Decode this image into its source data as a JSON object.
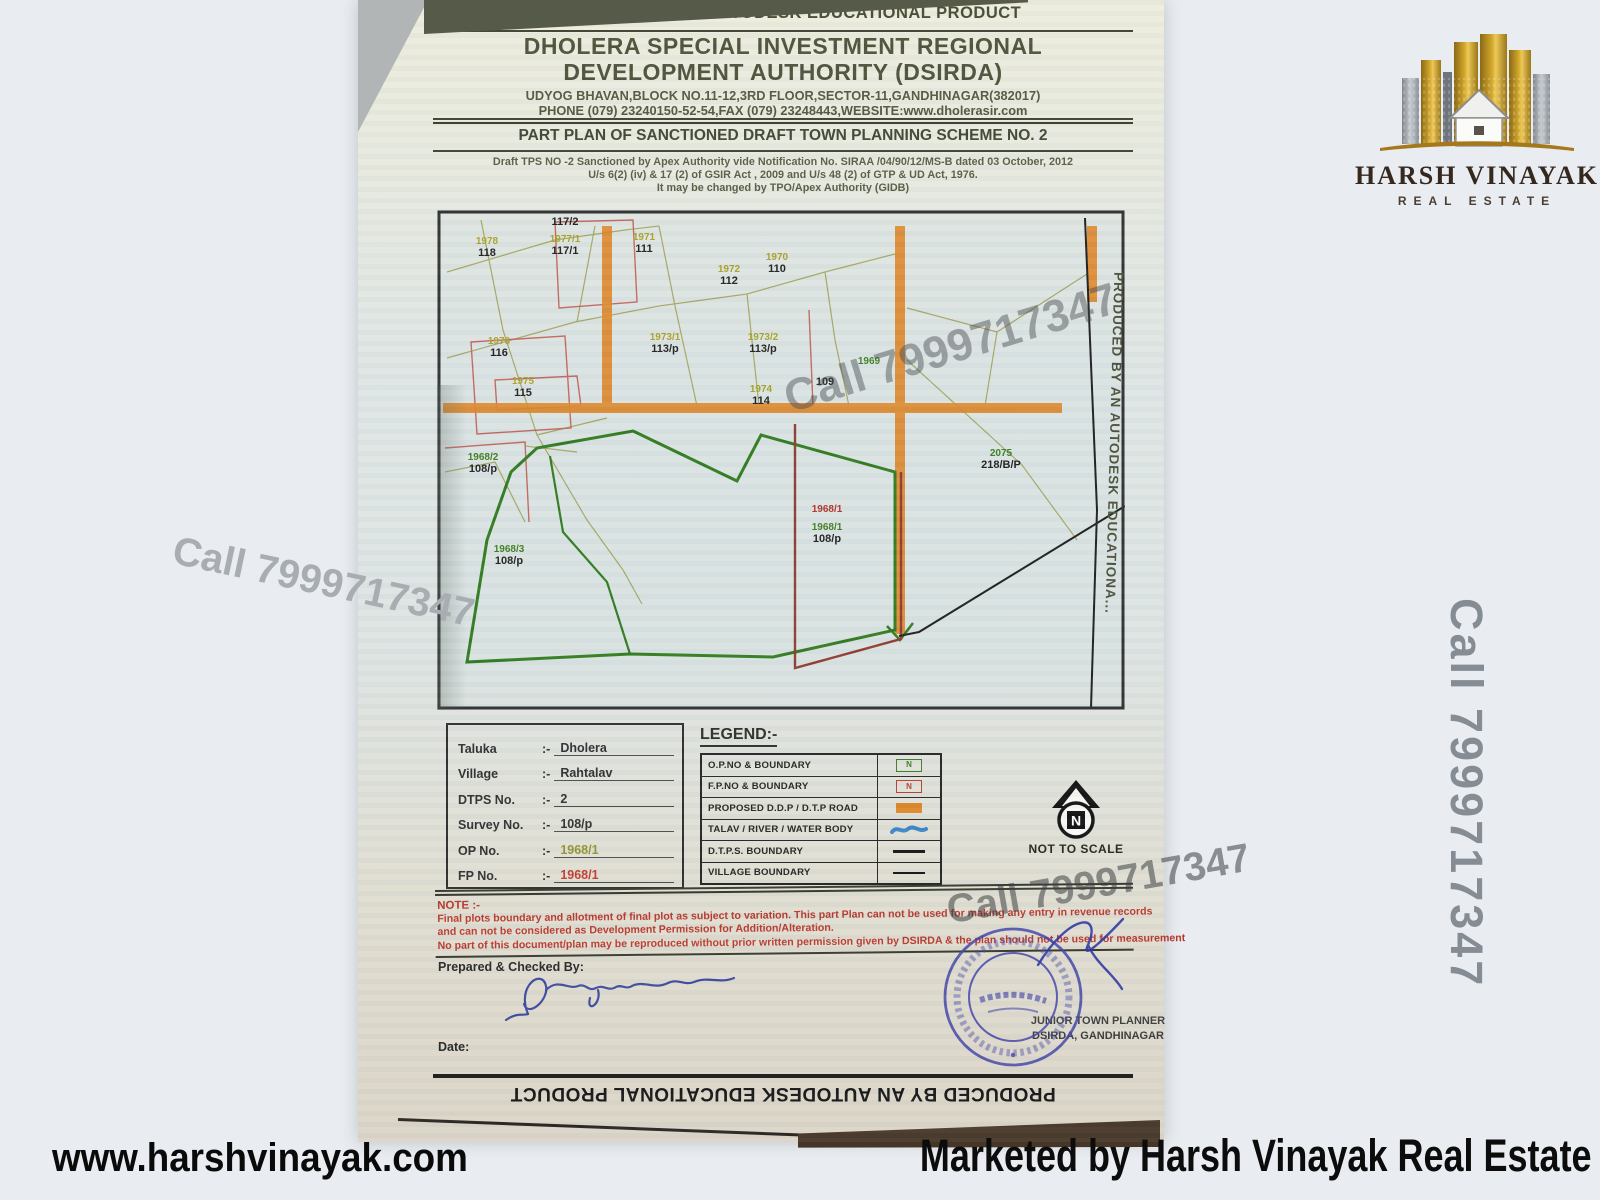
{
  "watermark_phone": "Call 7999717347",
  "footer": {
    "website": "www.harshvinayak.com",
    "marketed_by": "Marketed by Harsh Vinayak Real Estate"
  },
  "logo": {
    "title": "HARSH VINAYAK",
    "subtitle": "REAL ESTATE"
  },
  "doc": {
    "autodesk_banner_top": "PRODUCED BY AN AUTODESK EDUCATIONAL PRODUCT",
    "autodesk_banner_bottom": "PRODUCED BY AN AUTODESK EDUCATIONAL PRODUCT",
    "autodesk_banner_side": "PRODUCED BY AN AUTODESK EDUCATIONA...",
    "authority_name_line1": "DHOLERA SPECIAL INVESTMENT REGIONAL",
    "authority_name_line2": "DEVELOPMENT AUTHORITY (DSIRDA)",
    "address_line1": "UDYOG BHAVAN,BLOCK NO.11-12,3RD FLOOR,SECTOR-11,GANDHINAGAR(382017)",
    "address_line2": "PHONE (079) 23240150-52-54,FAX (079) 23248443,WEBSITE:www.dholerasir.com",
    "plan_title": "PART PLAN OF SANCTIONED DRAFT TOWN PLANNING SCHEME NO. 2",
    "notification_line1": "Draft TPS NO -2 Sanctioned by Apex Authority vide Notification No. SIRAA /04/90/12/MS-B dated 03 October, 2012",
    "notification_line2": "U/s 6(2) (iv)  &  17 (2) of  GSIR Act , 2009 and U/s 48 (2) of GTP & UD Act, 1976.",
    "notification_line3": "It may be changed by TPO/Apex Authority (GIDB)"
  },
  "map": {
    "plots": [
      {
        "op": "1978",
        "fp": "118"
      },
      {
        "op": "",
        "fp": "117/2"
      },
      {
        "op": "1977/1",
        "fp": "117/1"
      },
      {
        "op": "1971",
        "fp": "111"
      },
      {
        "op": "1970",
        "fp": "110"
      },
      {
        "op": "1972",
        "fp": "112"
      },
      {
        "op": "1973/1",
        "fp": "113/p"
      },
      {
        "op": "1973/2",
        "fp": "113/p"
      },
      {
        "op": "1969",
        "fp": ""
      },
      {
        "op": "",
        "fp": "109"
      },
      {
        "op": "1976",
        "fp": "116"
      },
      {
        "op": "1975",
        "fp": "115"
      },
      {
        "op": "1974",
        "fp": "114"
      },
      {
        "op": "1968/2",
        "fp": "108/p"
      },
      {
        "op": "1968/3",
        "fp": "108/p"
      },
      {
        "op": "1968/1",
        "fp": ""
      },
      {
        "op": "1968/1",
        "fp": "108/p"
      },
      {
        "op": "2075",
        "fp": "218/B/P"
      }
    ]
  },
  "info": {
    "rows": [
      {
        "label": "Taluka",
        "sep": ":-",
        "value": "Dholera"
      },
      {
        "label": "Village",
        "sep": ":-",
        "value": "Rahtalav"
      },
      {
        "label": "DTPS No.",
        "sep": ":-",
        "value": "2"
      },
      {
        "label": "Survey No.",
        "sep": ":-",
        "value": "108/p"
      },
      {
        "label": "OP No.",
        "sep": ":-",
        "value": "1968/1"
      },
      {
        "label": "FP No.",
        "sep": ":-",
        "value": "1968/1"
      }
    ]
  },
  "legend": {
    "title": "LEGEND:-",
    "symbol_n": "N",
    "rows": [
      {
        "label": "O.P.NO & BOUNDARY",
        "symbol": "op-number-box"
      },
      {
        "label": "F.P.NO & BOUNDARY",
        "symbol": "fp-number-box"
      },
      {
        "label": "PROPOSED D.D.P / D.T.P ROAD",
        "symbol": "orange-road-swatch"
      },
      {
        "label": "TALAV / RIVER / WATER BODY",
        "symbol": "water-wave"
      },
      {
        "label": "D.T.P.S. BOUNDARY",
        "symbol": "black-line"
      },
      {
        "label": "VILLAGE BOUNDARY",
        "symbol": "black-line"
      }
    ]
  },
  "north": {
    "label": "NOT TO SCALE",
    "letter": "N"
  },
  "note": {
    "title": "NOTE :-",
    "lines": [
      "Final plots boundary and allotment of final plot as subject to variation. This part Plan can not be used for making any entry in revenue records",
      "and can not be considered as Development Permission for Addition/Alteration.",
      "No part of this document/plan may be reproduced without prior written permission given by DSIRDA & the plan should not be used for measurement"
    ]
  },
  "signoff": {
    "prepared_label": "Prepared & Checked By:",
    "date_label": "Date:",
    "officer_line1": "JUNIOR TOWN PLANNER",
    "officer_line2": "DSIRDA, GANDHINAGAR",
    "stamp_center": "ગાંધીનગર"
  }
}
